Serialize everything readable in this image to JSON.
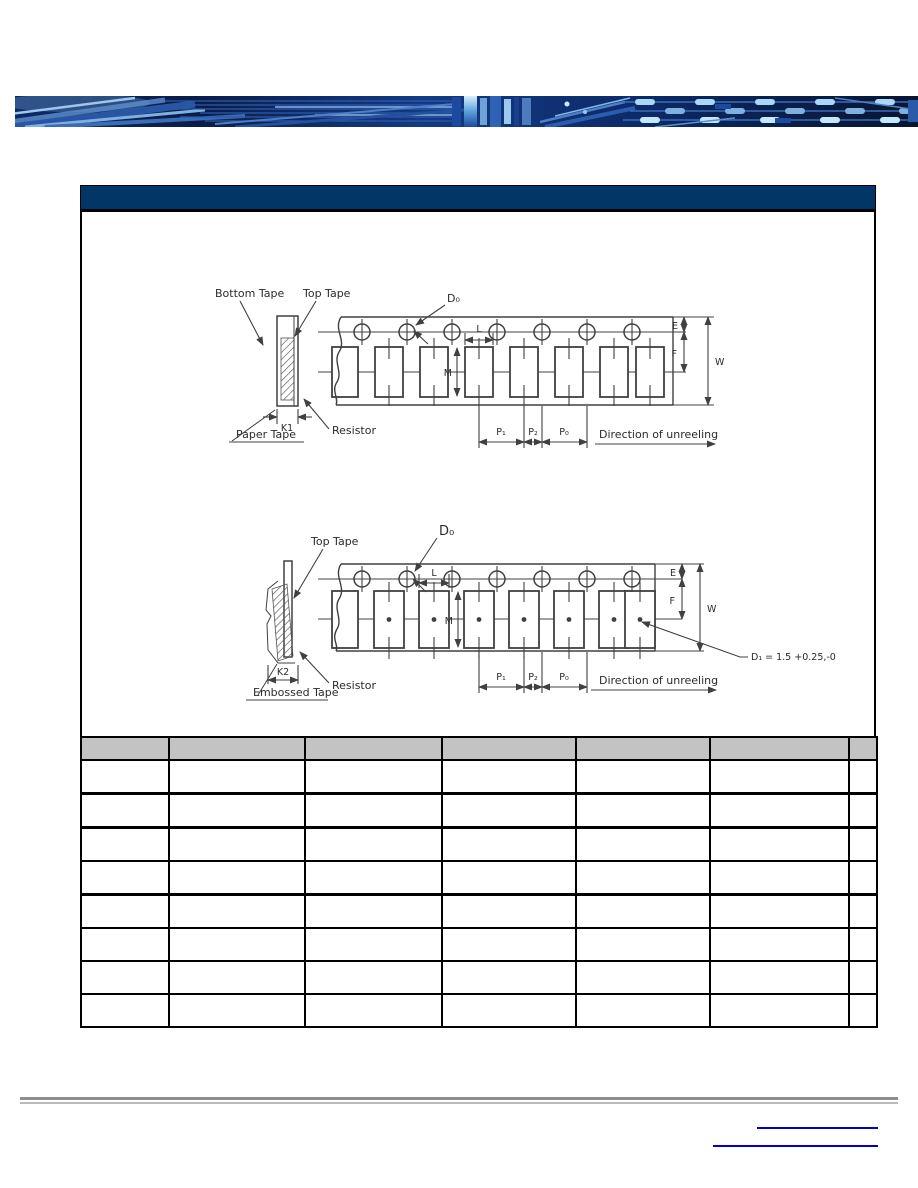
{
  "document": {
    "type": "component-datasheet-page"
  },
  "colors": {
    "header_bar": "#003767",
    "table_header_fill": "#c3c3c3",
    "link_underline": "#0000cc",
    "divider_dark": "#8f8f8f",
    "divider_light": "#bababa",
    "diagram_line": "#404040",
    "banner_base": "#0c2a67",
    "banner_trace": "#7fb0e0"
  },
  "section_header": {
    "label": ""
  },
  "paper_tape_diagram": {
    "bottom_tape": "Bottom Tape",
    "top_tape": "Top Tape",
    "d0": "D₀",
    "l": "L",
    "m": "M",
    "e": "E",
    "f": "F",
    "w": "W",
    "k1": "K1",
    "paper_tape": "Paper Tape",
    "resistor": "Resistor",
    "p1": "P₁",
    "p2": "P₂",
    "p0": "P₀",
    "direction": "Direction of unreeling"
  },
  "embossed_tape_diagram": {
    "top_tape": "Top Tape",
    "d0": "D₀",
    "l": "L",
    "m": "M",
    "e": "E",
    "f": "F",
    "w": "W",
    "k2": "K2",
    "embossed_tape": "Embossed Tape",
    "resistor": "Resistor",
    "d1_note": "D₁ = 1.5 +0.25,-0",
    "p1": "P₁",
    "p2": "P₂",
    "p0": "P₀",
    "direction": "Direction of unreeling"
  },
  "dimension_table": {
    "header": [
      "",
      "",
      "",
      "",
      "",
      "",
      ""
    ],
    "rows": [
      [
        "",
        "",
        "",
        "",
        "",
        "",
        ""
      ],
      [
        "",
        "",
        "",
        "",
        "",
        "",
        ""
      ],
      [
        "",
        "",
        "",
        "",
        "",
        "",
        ""
      ],
      [
        "",
        "",
        "",
        "",
        "",
        "",
        ""
      ],
      [
        "",
        "",
        "",
        "",
        "",
        "",
        ""
      ],
      [
        "",
        "",
        "",
        "",
        "",
        "",
        ""
      ],
      [
        "",
        "",
        "",
        "",
        "",
        "",
        ""
      ],
      [
        "",
        "",
        "",
        "",
        "",
        "",
        ""
      ]
    ]
  },
  "footer": {
    "link_labels": [
      "",
      ""
    ]
  }
}
